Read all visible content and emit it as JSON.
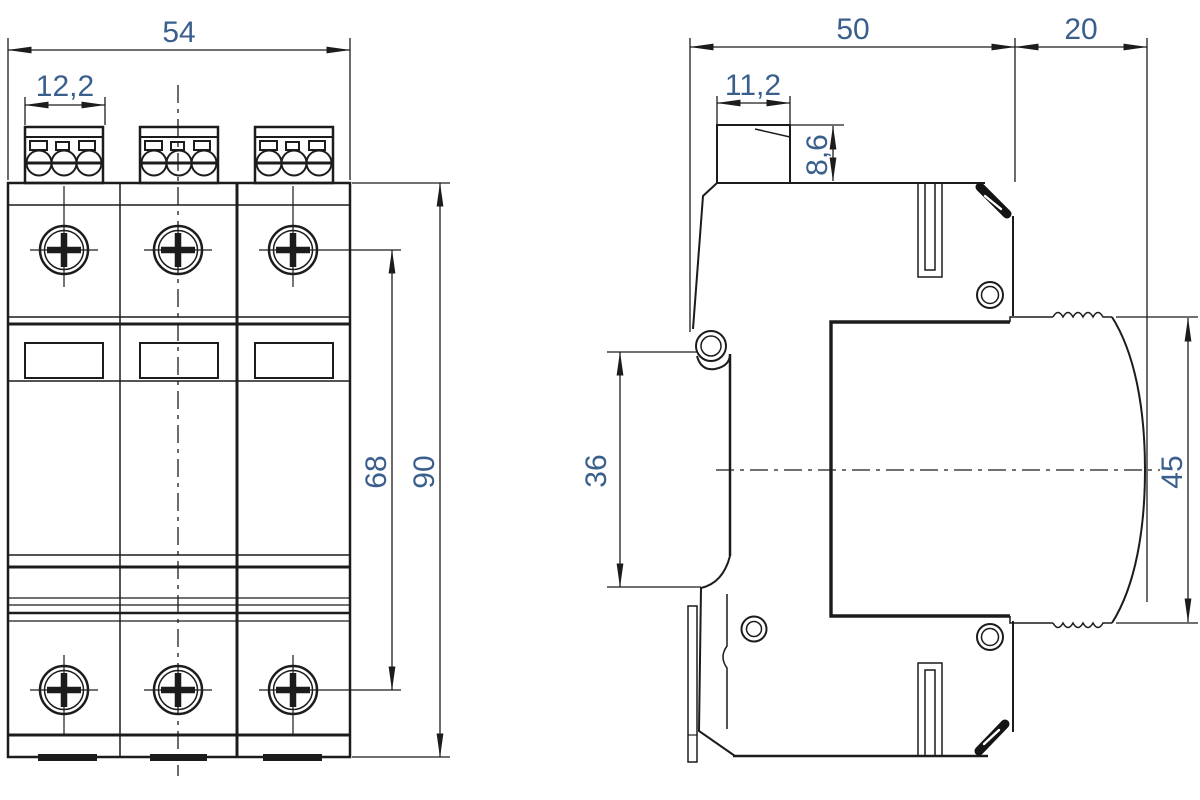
{
  "drawing": {
    "description": "DIN-rail surge protection device - dimensional drawing with front view and side view",
    "units": "mm",
    "colors": {
      "line": "#1c1c1c",
      "dim_text": "#3a5f8c",
      "background": "#ffffff"
    },
    "front_view": {
      "label": "front view",
      "dims": {
        "overall_width": "54",
        "terminal_width": "12,2",
        "screw_span": "68",
        "overall_height": "90"
      }
    },
    "side_view": {
      "label": "side view",
      "dims": {
        "base_depth": "50",
        "front_module_depth": "20",
        "terminal_depth": "11,2",
        "terminal_height": "8,6",
        "back_recess_height": "36",
        "front_module_height": "45"
      }
    }
  }
}
